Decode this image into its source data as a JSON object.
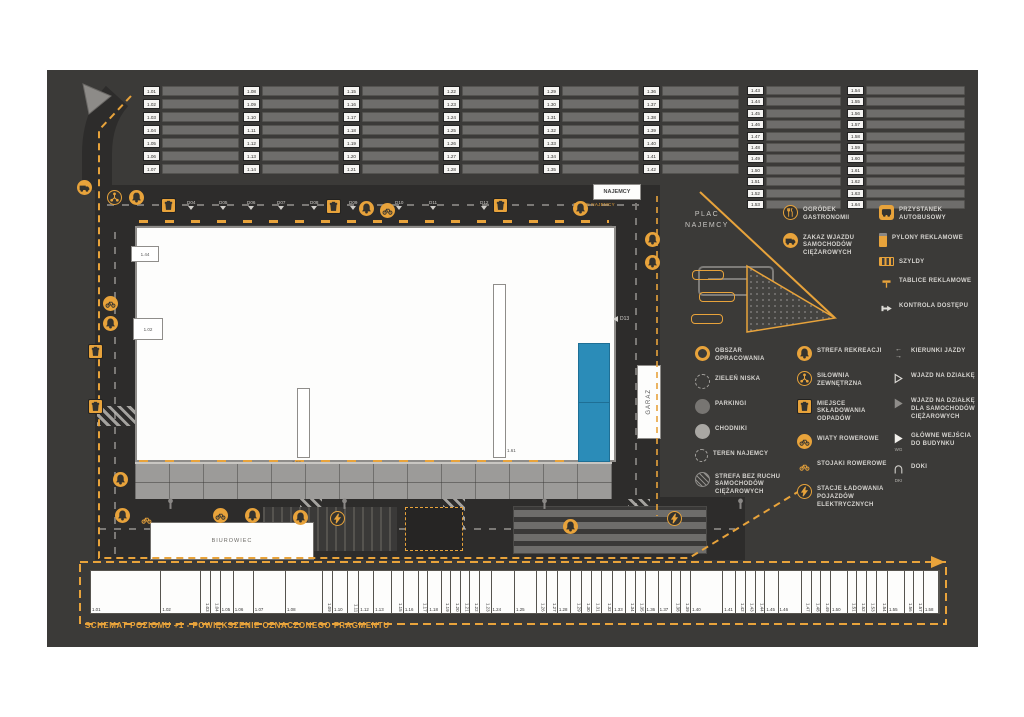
{
  "title": "SCHEMAT POZIOMU +1 - POWIĘKSZENIE OZNACZONEGO FRAGMENTU",
  "colors": {
    "canvas": "#3b3a38",
    "accent": "#e8a33b",
    "road": "#2d2c2b",
    "building": "#fdfdfc",
    "blue_zone": "#2b8cb8",
    "sidewalk": "#9c9b99"
  },
  "plan": {
    "labels": {
      "najemcy": "NAJEMCY",
      "teren_najemcy": "TEREN NAJEMCY",
      "plac_line1": "PLAC",
      "plac_line2": "NAJEMCY",
      "garaz": "GARAŻ",
      "biurowiec": "BIUROWIEC",
      "dock_right": "D13"
    },
    "unit_boxes": {
      "a": "1.44",
      "b": "1.02",
      "c": "1.62",
      "d": "1.61"
    },
    "docks": [
      "D04",
      "D05",
      "D06",
      "D07",
      "D08",
      "D09",
      "D10",
      "D11",
      "D12"
    ]
  },
  "parking_top": {
    "groups": [
      [
        "1.01",
        "1.02",
        "1.03",
        "1.04",
        "1.05",
        "1.06",
        "1.07"
      ],
      [
        "1.08",
        "1.09",
        "1.10",
        "1.11",
        "1.12",
        "1.13",
        "1.14"
      ],
      [
        "1.15",
        "1.16",
        "1.17",
        "1.18",
        "1.19",
        "1.20",
        "1.21"
      ],
      [
        "1.22",
        "1.23",
        "1.24",
        "1.25",
        "1.26",
        "1.27",
        "1.28"
      ],
      [
        "1.29",
        "1.30",
        "1.31",
        "1.32",
        "1.33",
        "1.34",
        "1.35"
      ],
      [
        "1.36",
        "1.37",
        "1.38",
        "1.39",
        "1.40",
        "1.41",
        "1.42"
      ],
      [
        "1.43",
        "1.44",
        "1.45",
        "1.46",
        "1.47",
        "1.48",
        "1.49",
        "1.50",
        "1.51",
        "1.52",
        "1.53"
      ],
      [
        "1.54",
        "1.55",
        "1.56",
        "1.57",
        "1.58",
        "1.59",
        "1.60",
        "1.61",
        "1.62",
        "1.63",
        "1.64"
      ]
    ]
  },
  "bottom_strip": {
    "units": [
      {
        "label": "1.01",
        "w": 8
      },
      {
        "label": "1.02",
        "w": 4.5
      },
      {
        "label": "1.03",
        "w": 1
      },
      {
        "label": "1.04",
        "w": 1
      },
      {
        "label": "1.05",
        "w": 1.4
      },
      {
        "label": "1.06",
        "w": 2.2
      },
      {
        "label": "1.07",
        "w": 3.6
      },
      {
        "label": "1.08",
        "w": 4.2
      },
      {
        "label": "1.09",
        "w": 1
      },
      {
        "label": "1.10",
        "w": 1.6
      },
      {
        "label": "1.11",
        "w": 1.2
      },
      {
        "label": "1.12",
        "w": 1.6
      },
      {
        "label": "1.13",
        "w": 2
      },
      {
        "label": "1.15",
        "w": 1.2
      },
      {
        "label": "1.16",
        "w": 1.6
      },
      {
        "label": "1.17",
        "w": 1
      },
      {
        "label": "1.18",
        "w": 1.4
      },
      {
        "label": "1.19",
        "w": 1
      },
      {
        "label": "1.20",
        "w": 1
      },
      {
        "label": "1.21",
        "w": 1
      },
      {
        "label": "1.22",
        "w": 1
      },
      {
        "label": "1.23",
        "w": 1.2
      },
      {
        "label": "1.24",
        "w": 2.6
      },
      {
        "label": "1.25",
        "w": 2.4
      },
      {
        "label": "1.26",
        "w": 1
      },
      {
        "label": "1.27",
        "w": 1.2
      },
      {
        "label": "1.28",
        "w": 1.4
      },
      {
        "label": "1.29",
        "w": 1.2
      },
      {
        "label": "1.30",
        "w": 1
      },
      {
        "label": "1.31",
        "w": 1
      },
      {
        "label": "1.32",
        "w": 1.2
      },
      {
        "label": "1.33",
        "w": 1.4
      },
      {
        "label": "1.34",
        "w": 1
      },
      {
        "label": "1.35",
        "w": 1
      },
      {
        "label": "1.36",
        "w": 1.4
      },
      {
        "label": "1.37",
        "w": 1.4
      },
      {
        "label": "1.38",
        "w": 1
      },
      {
        "label": "1.39",
        "w": 1
      },
      {
        "label": "1.40",
        "w": 3.6
      },
      {
        "label": "1.41",
        "w": 1.4
      },
      {
        "label": "1.42",
        "w": 1
      },
      {
        "label": "1.43",
        "w": 1
      },
      {
        "label": "1.44",
        "w": 1
      },
      {
        "label": "1.45",
        "w": 1.4
      },
      {
        "label": "1.46",
        "w": 2.6
      },
      {
        "label": "1.47",
        "w": 1
      },
      {
        "label": "1.48",
        "w": 1
      },
      {
        "label": "1.49",
        "w": 1
      },
      {
        "label": "1.50",
        "w": 1.8
      },
      {
        "label": "1.51",
        "w": 1
      },
      {
        "label": "1.52",
        "w": 1
      },
      {
        "label": "1.53",
        "w": 1
      },
      {
        "label": "1.54",
        "w": 1.2
      },
      {
        "label": "1.55",
        "w": 1.8
      },
      {
        "label": "1.56",
        "w": 1
      },
      {
        "label": "1.57",
        "w": 1
      },
      {
        "label": "1.58",
        "w": 1.6
      }
    ]
  },
  "legend_top": {
    "col1": [
      {
        "icon": "gastro-circle",
        "label": "OGRÓDEK GASTRONOMII"
      },
      {
        "icon": "no-truck-circle",
        "label": "ZAKAZ WJAZDU SAMOCHODÓW CIĘŻAROWYCH"
      }
    ],
    "col2": [
      {
        "icon": "bus-badge",
        "label": "PRZYSTANEK AUTOBUSOWY"
      },
      {
        "icon": "pylon",
        "label": "PYLONY REKLAMOWE"
      },
      {
        "icon": "signboard",
        "label": "SZYLDY"
      },
      {
        "icon": "adboard",
        "label": "TABLICE REKLAMOWE"
      },
      {
        "icon": "access",
        "label": "KONTROLA DOSTĘPU"
      }
    ]
  },
  "legend_main": {
    "col1": [
      {
        "icon": "ring-yellow",
        "label": "OBSZAR OPRACOWANIA"
      },
      {
        "icon": "ring-dash",
        "label": "ZIELEŃ NISKA"
      },
      {
        "icon": "circle-dark",
        "label": "PARKINGI"
      },
      {
        "icon": "circle-light",
        "label": "CHODNIKI"
      },
      {
        "icon": "ring-dash2",
        "label": "TEREN NAJEMCY"
      },
      {
        "icon": "circle-hatch",
        "label": "STREFA BEZ RUCHU SAMOCHODÓW CIĘŻAROWYCH"
      }
    ],
    "col2": [
      {
        "icon": "bell-circle",
        "label": "STREFA REKREACJI"
      },
      {
        "icon": "gym-circle",
        "label": "SIŁOWNIA ZEWNĘTRZNA"
      },
      {
        "icon": "trash-square",
        "label": "MIEJSCE SKŁADOWANIA ODPADÓW"
      },
      {
        "icon": "bike-circle",
        "label": "WIATY ROWEROWE"
      },
      {
        "icon": "bike-small",
        "label": "STOJAKI ROWEROWE"
      },
      {
        "icon": "ev-circle",
        "label": "STACJE ŁADOWANIA POJAZDÓW ELEKTRYCZNYCH"
      }
    ],
    "col3": [
      {
        "icon": "arrows",
        "label": "KIERUNKI JAZDY"
      },
      {
        "icon": "tri-outline",
        "label": "WJAZD NA DZIAŁKĘ"
      },
      {
        "icon": "tri-gray",
        "label": "WJAZD NA DZIAŁKĘ DLA SAMOCHODÓW CIĘŻAROWYCH"
      },
      {
        "icon": "tri-white",
        "label": "GŁÓWNE WEJŚCIA DO BUDYNKU",
        "tag": "WG"
      },
      {
        "icon": "dock",
        "label": "DOKI",
        "tag": "DKI"
      }
    ]
  }
}
